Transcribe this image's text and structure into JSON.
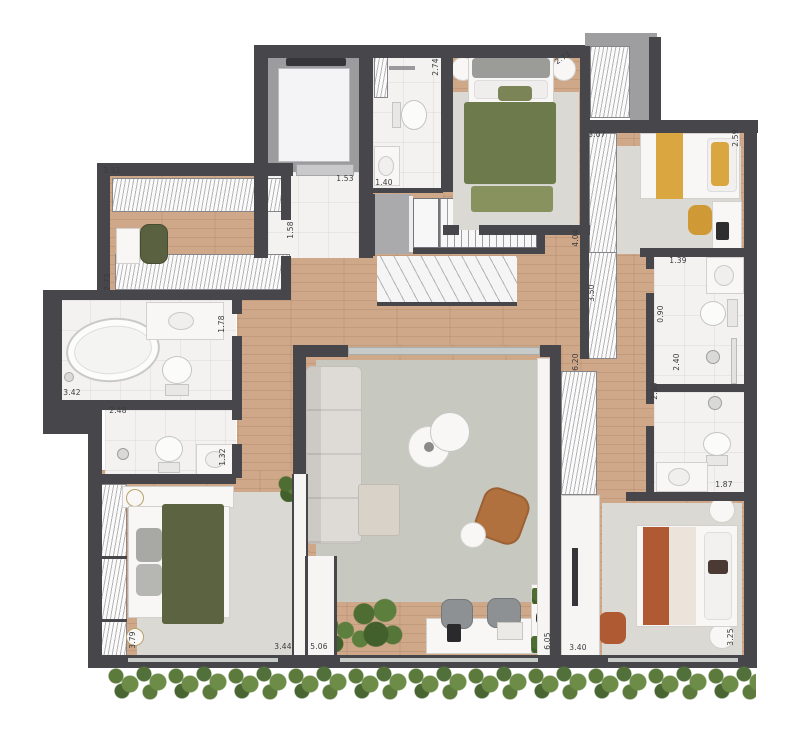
{
  "plan_type": "apartment-floor-plan-top-view",
  "palette": {
    "wall": "#47474b",
    "wood_floor": "#cfa88a",
    "tile_floor": "#f3f2f0",
    "rug": "#c7c9c1",
    "rug_light": "#dbd9d3",
    "bed_green": "#6d7a4b",
    "bed_olive": "#5c6340",
    "accent_yellow": "#d9a63f",
    "accent_terracotta": "#b05a33",
    "hedge_green": "#5c7a3c"
  },
  "dims": {
    "dressing_w": "3.51",
    "dressing_d": "2.73",
    "hall_w": "1.53",
    "bath_top_w": "1.40",
    "hall_d": "1.58",
    "bed1_left": "2.74",
    "bed1_right": "2.71",
    "bed2_w": "3.07",
    "bed2_d": "2.59",
    "corridor_d": "4.04",
    "wardrobe_upper": "3.50",
    "bath_a_w": "1.39",
    "corridor_n": "0.90",
    "bath_a_d": "2.40",
    "bath_b_d": "2.30",
    "bath_b_w": "1.87",
    "wardrobe_lower": "6.20",
    "mbath_w": "3.42",
    "mbath_d": "1.78",
    "bath2_w": "2.48",
    "bath2_d": "1.32",
    "bed3_d": "3.79",
    "bed3_w": "3.44",
    "living_w": "5.06",
    "living_d": "6.05",
    "bed4_w": "3.40",
    "bed4_d": "3.25"
  }
}
